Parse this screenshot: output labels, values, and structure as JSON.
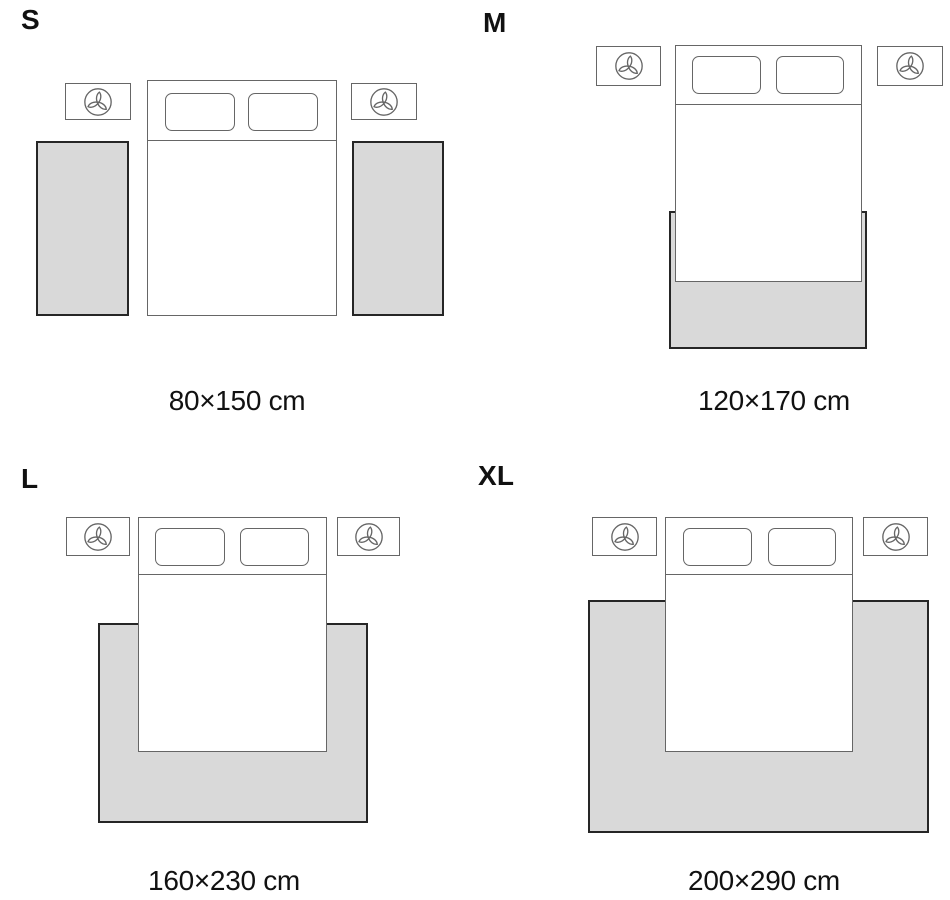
{
  "colors": {
    "background": "#ffffff",
    "rug_fill": "#d9d9d9",
    "rug_border": "#262626",
    "furniture_outline": "#666666",
    "text_primary": "#111111"
  },
  "icons": {
    "nightstand_icon": "plant-icon"
  },
  "sizes": [
    {
      "label": "S",
      "dimensions": "80×150 cm"
    },
    {
      "label": "M",
      "dimensions": "120×170 cm"
    },
    {
      "label": "L",
      "dimensions": "160×230 cm"
    },
    {
      "label": "XL",
      "dimensions": "200×290 cm"
    }
  ]
}
